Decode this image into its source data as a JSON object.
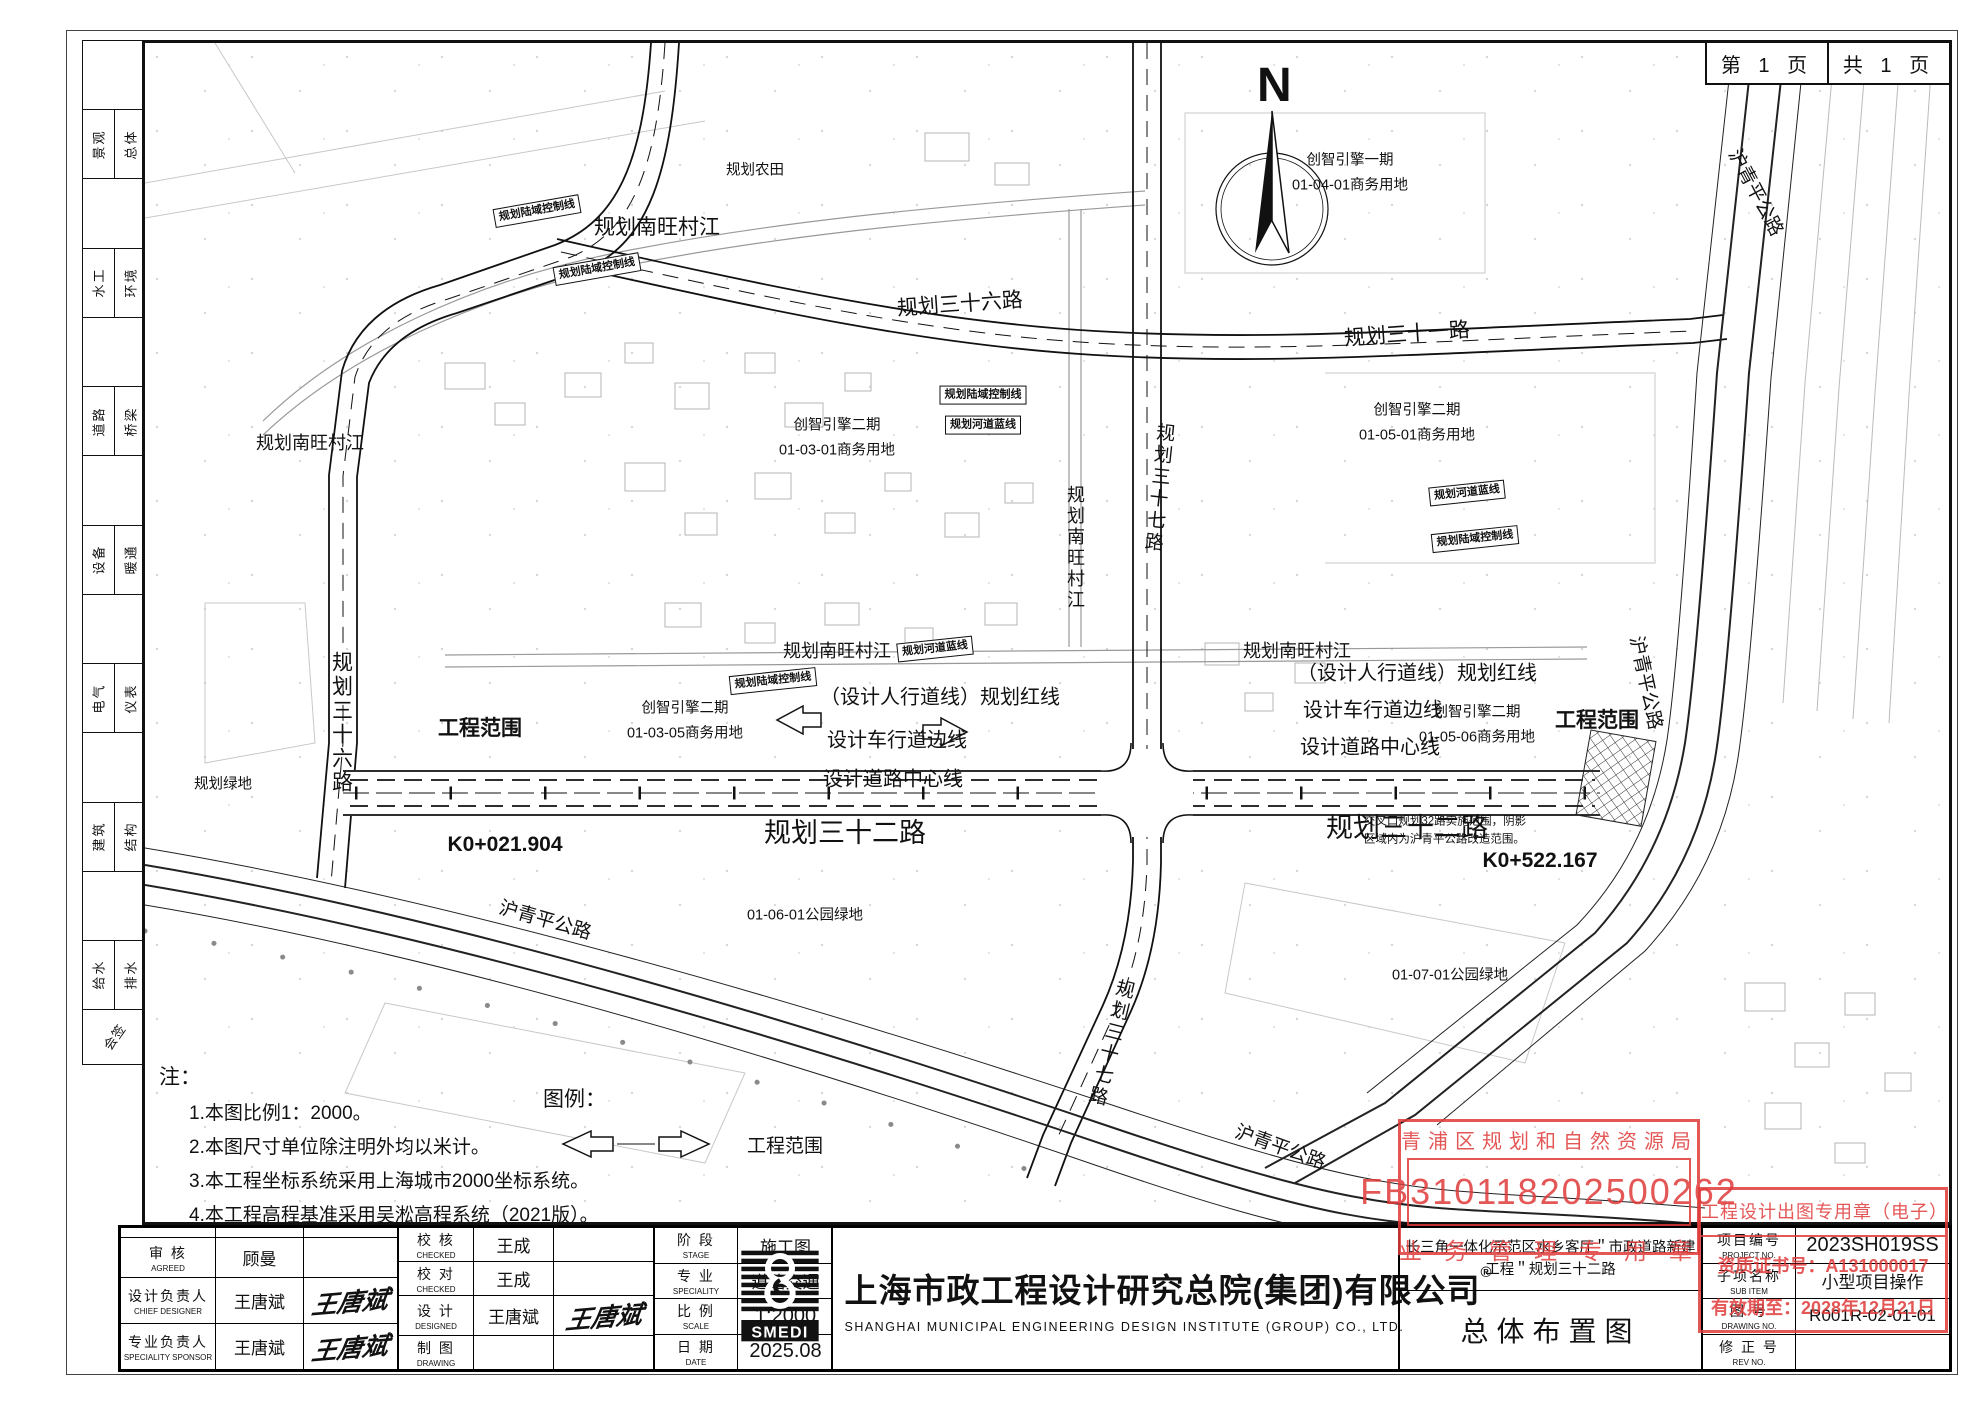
{
  "page": {
    "page_no": "第 1 页",
    "page_total": "共 1 页",
    "north_label": "N"
  },
  "sidebar": {
    "disciplines": [
      {
        "a": "景观",
        "b": "总体"
      },
      {
        "a": "水工",
        "b": "环境"
      },
      {
        "a": "道路",
        "b": "桥梁"
      },
      {
        "a": "设备",
        "b": "暖通"
      },
      {
        "a": "电气",
        "b": "仪表"
      },
      {
        "a": "建筑",
        "b": "结构"
      },
      {
        "a": "给水",
        "b": "排水"
      }
    ],
    "sign_label": "会签"
  },
  "map": {
    "labels": [
      {
        "t": "规划南旺村江",
        "x": 512,
        "y": 185,
        "cls": "riv20"
      },
      {
        "t": "规划三十六路",
        "x": 815,
        "y": 262,
        "cls": "road20",
        "rot": -4
      },
      {
        "t": "规划三十一路",
        "x": 1262,
        "y": 292,
        "cls": "road20",
        "rot": -4
      },
      {
        "t": "规划南旺村江",
        "x": 165,
        "y": 400,
        "cls": "riv18"
      },
      {
        "t": "规划农田",
        "x": 610,
        "y": 128,
        "cls": "area"
      },
      {
        "t": "创智引擎一期\n01-04-01商务用地",
        "x": 1205,
        "y": 130,
        "cls": "area"
      },
      {
        "t": "创智引擎二期\n01-03-01商务用地",
        "x": 692,
        "y": 395,
        "cls": "area"
      },
      {
        "t": "创智引擎二期\n01-05-01商务用地",
        "x": 1272,
        "y": 380,
        "cls": "area"
      },
      {
        "t": "创智引擎二期\n01-03-05商务用地",
        "x": 540,
        "y": 678,
        "cls": "area"
      },
      {
        "t": "创智引擎二期\n01-05-06商务用地",
        "x": 1332,
        "y": 682,
        "cls": "area"
      },
      {
        "t": "01-06-01公园绿地",
        "x": 660,
        "y": 873,
        "cls": "area"
      },
      {
        "t": "01-07-01公园绿地",
        "x": 1305,
        "y": 933,
        "cls": "area"
      },
      {
        "t": "规划绿地",
        "x": 78,
        "y": 742,
        "cls": "area"
      },
      {
        "t": "规划南旺村江",
        "x": 930,
        "y": 505,
        "cls": "riv18 vert"
      },
      {
        "t": "规划三十七路",
        "x": 1013,
        "y": 445,
        "cls": "road18 vert",
        "rot": 6
      },
      {
        "t": "规划三十七路",
        "x": 965,
        "y": 1000,
        "cls": "road18 vert",
        "rot": 14
      },
      {
        "t": "规划南旺村江",
        "x": 692,
        "y": 608,
        "cls": "riv18"
      },
      {
        "t": "规划南旺村江",
        "x": 1152,
        "y": 608,
        "cls": "riv18"
      },
      {
        "t": "（设计人行道线）规划红线",
        "x": 795,
        "y": 655,
        "cls": "anno"
      },
      {
        "t": "设计车行道边线",
        "x": 752,
        "y": 698,
        "cls": "anno"
      },
      {
        "t": "设计道路中心线",
        "x": 748,
        "y": 737,
        "cls": "anno"
      },
      {
        "t": "（设计人行道线）规划红线",
        "x": 1272,
        "y": 631,
        "cls": "anno"
      },
      {
        "t": "设计车行道边线",
        "x": 1228,
        "y": 668,
        "cls": "anno"
      },
      {
        "t": "设计道路中心线",
        "x": 1225,
        "y": 705,
        "cls": "anno"
      },
      {
        "t": "工程范围",
        "x": 335,
        "y": 686,
        "cls": "boldlbl"
      },
      {
        "t": "工程范围",
        "x": 1452,
        "y": 678,
        "cls": "boldlbl"
      },
      {
        "t": "K0+021.904",
        "x": 360,
        "y": 802,
        "cls": "boldlbl"
      },
      {
        "t": "K0+522.167",
        "x": 1395,
        "y": 818,
        "cls": "boldlbl"
      },
      {
        "t": "交叉口规划32路实施范围，阴影\n区域内为沪青平公路改造范围。",
        "x": 1300,
        "y": 788,
        "cls": "tiny"
      },
      {
        "t": "规划三十二路",
        "x": 700,
        "y": 790,
        "cls": "road24"
      },
      {
        "t": "规划三十二路",
        "x": 1262,
        "y": 785,
        "cls": "road24"
      },
      {
        "t": "规划三十六路",
        "x": 196,
        "y": 680,
        "cls": "road20 vert"
      },
      {
        "t": "沪青平公路",
        "x": 1610,
        "y": 150,
        "cls": "road18",
        "rot": 62
      },
      {
        "t": "沪青平公路",
        "x": 1500,
        "y": 640,
        "cls": "road18",
        "rot": 78
      },
      {
        "t": "沪青平公路",
        "x": 400,
        "y": 878,
        "cls": "road18",
        "rot": 16
      },
      {
        "t": "沪青平公路",
        "x": 1135,
        "y": 1105,
        "cls": "road18",
        "rot": 20
      },
      {
        "t": "规划陆域控制线",
        "x": 392,
        "y": 168,
        "cls": "boxed",
        "rot": -10
      },
      {
        "t": "规划陆域控制线",
        "x": 452,
        "y": 226,
        "cls": "boxed",
        "rot": -10
      },
      {
        "t": "规划陆域控制线",
        "x": 628,
        "y": 638,
        "cls": "boxed",
        "rot": -6
      },
      {
        "t": "规划河道蓝线",
        "x": 790,
        "y": 606,
        "cls": "boxed",
        "rot": -6
      },
      {
        "t": "规划陆域控制线",
        "x": 838,
        "y": 352,
        "cls": "boxed"
      },
      {
        "t": "规划河道蓝线",
        "x": 838,
        "y": 382,
        "cls": "boxed"
      },
      {
        "t": "规划河道蓝线",
        "x": 1322,
        "y": 450,
        "cls": "boxed",
        "rot": -6
      },
      {
        "t": "规划陆域控制线",
        "x": 1330,
        "y": 496,
        "cls": "boxed",
        "rot": -6
      }
    ],
    "notes": {
      "title": "注：",
      "items": [
        "1.本图比例1：2000。",
        "2.本图尺寸单位除注明外均以米计。",
        "3.本工程坐标系统采用上海城市2000坐标系统。",
        "4.本工程高程基准采用吴淞高程系统（2021版）。"
      ]
    },
    "legend": {
      "title": "图例：",
      "scope_label": "工程范围"
    }
  },
  "stamps": {
    "planning": {
      "line1": "青浦区规划和自然资源局",
      "line2": "FB310118202500262",
      "line3": "业务管理专用章",
      "color": "#e03a3a"
    },
    "design": {
      "line1": "工程设计出图专用章（电子）",
      "line2": "资质证书号：A131000017",
      "line3": "有效期至：2028年12月21日"
    }
  },
  "titleblock": {
    "left_rows": [
      {
        "label": "",
        "en": "",
        "name": "",
        "sign": ""
      },
      {
        "label": "审  核",
        "en": "AGREED",
        "name": "顾曼",
        "sign": ""
      },
      {
        "label": "设计负责人",
        "en": "CHIEF DESIGNER",
        "name": "王唐斌",
        "sign": "王唐斌"
      },
      {
        "label": "专业负责人",
        "en": "SPECIALITY SPONSOR",
        "name": "王唐斌",
        "sign": "王唐斌"
      }
    ],
    "mid_rows": [
      {
        "label": "校  核",
        "en": "CHECKED",
        "name": "王成",
        "sign": ""
      },
      {
        "label": "校  对",
        "en": "CHECKED",
        "name": "王成",
        "sign": ""
      },
      {
        "label": "设  计",
        "en": "DESIGNED",
        "name": "王唐斌",
        "sign": "王唐斌"
      },
      {
        "label": "制  图",
        "en": "DRAWING",
        "name": "",
        "sign": ""
      }
    ],
    "stage_rows": [
      {
        "label": "阶  段",
        "en": "STAGE",
        "value": "施工图"
      },
      {
        "label": "专  业",
        "en": "SPECIALITY",
        "value": "道路交通"
      },
      {
        "label": "比  例",
        "en": "SCALE",
        "value": "1:2000"
      },
      {
        "label": "日  期",
        "en": "DATE",
        "value": "2025.08"
      }
    ],
    "company": {
      "logo_text": "SMEDI",
      "reg_mark": "®",
      "cn": "上海市政工程设计研究总院(集团)有限公司",
      "en": "SHANGHAI MUNICIPAL ENGINEERING DESIGN INSTITUTE (GROUP) CO., LTD."
    },
    "project": {
      "name_line1": "长三角一体化示范区水乡客厅＂市政道路新建",
      "name_line2": "工程＂规划三十二路",
      "drawing_title": "总体布置图"
    },
    "right_rows": [
      {
        "label": "项目编号",
        "en": "PROJECT NO.",
        "value": "2023SH019SS"
      },
      {
        "label": "子项名称",
        "en": "SUB ITEM",
        "value": "小型项目操作"
      },
      {
        "label": "图  号",
        "en": "DRAWING NO.",
        "value": "R001R-02-01-01"
      },
      {
        "label": "修 正 号",
        "en": "REV NO.",
        "value": ""
      }
    ]
  }
}
